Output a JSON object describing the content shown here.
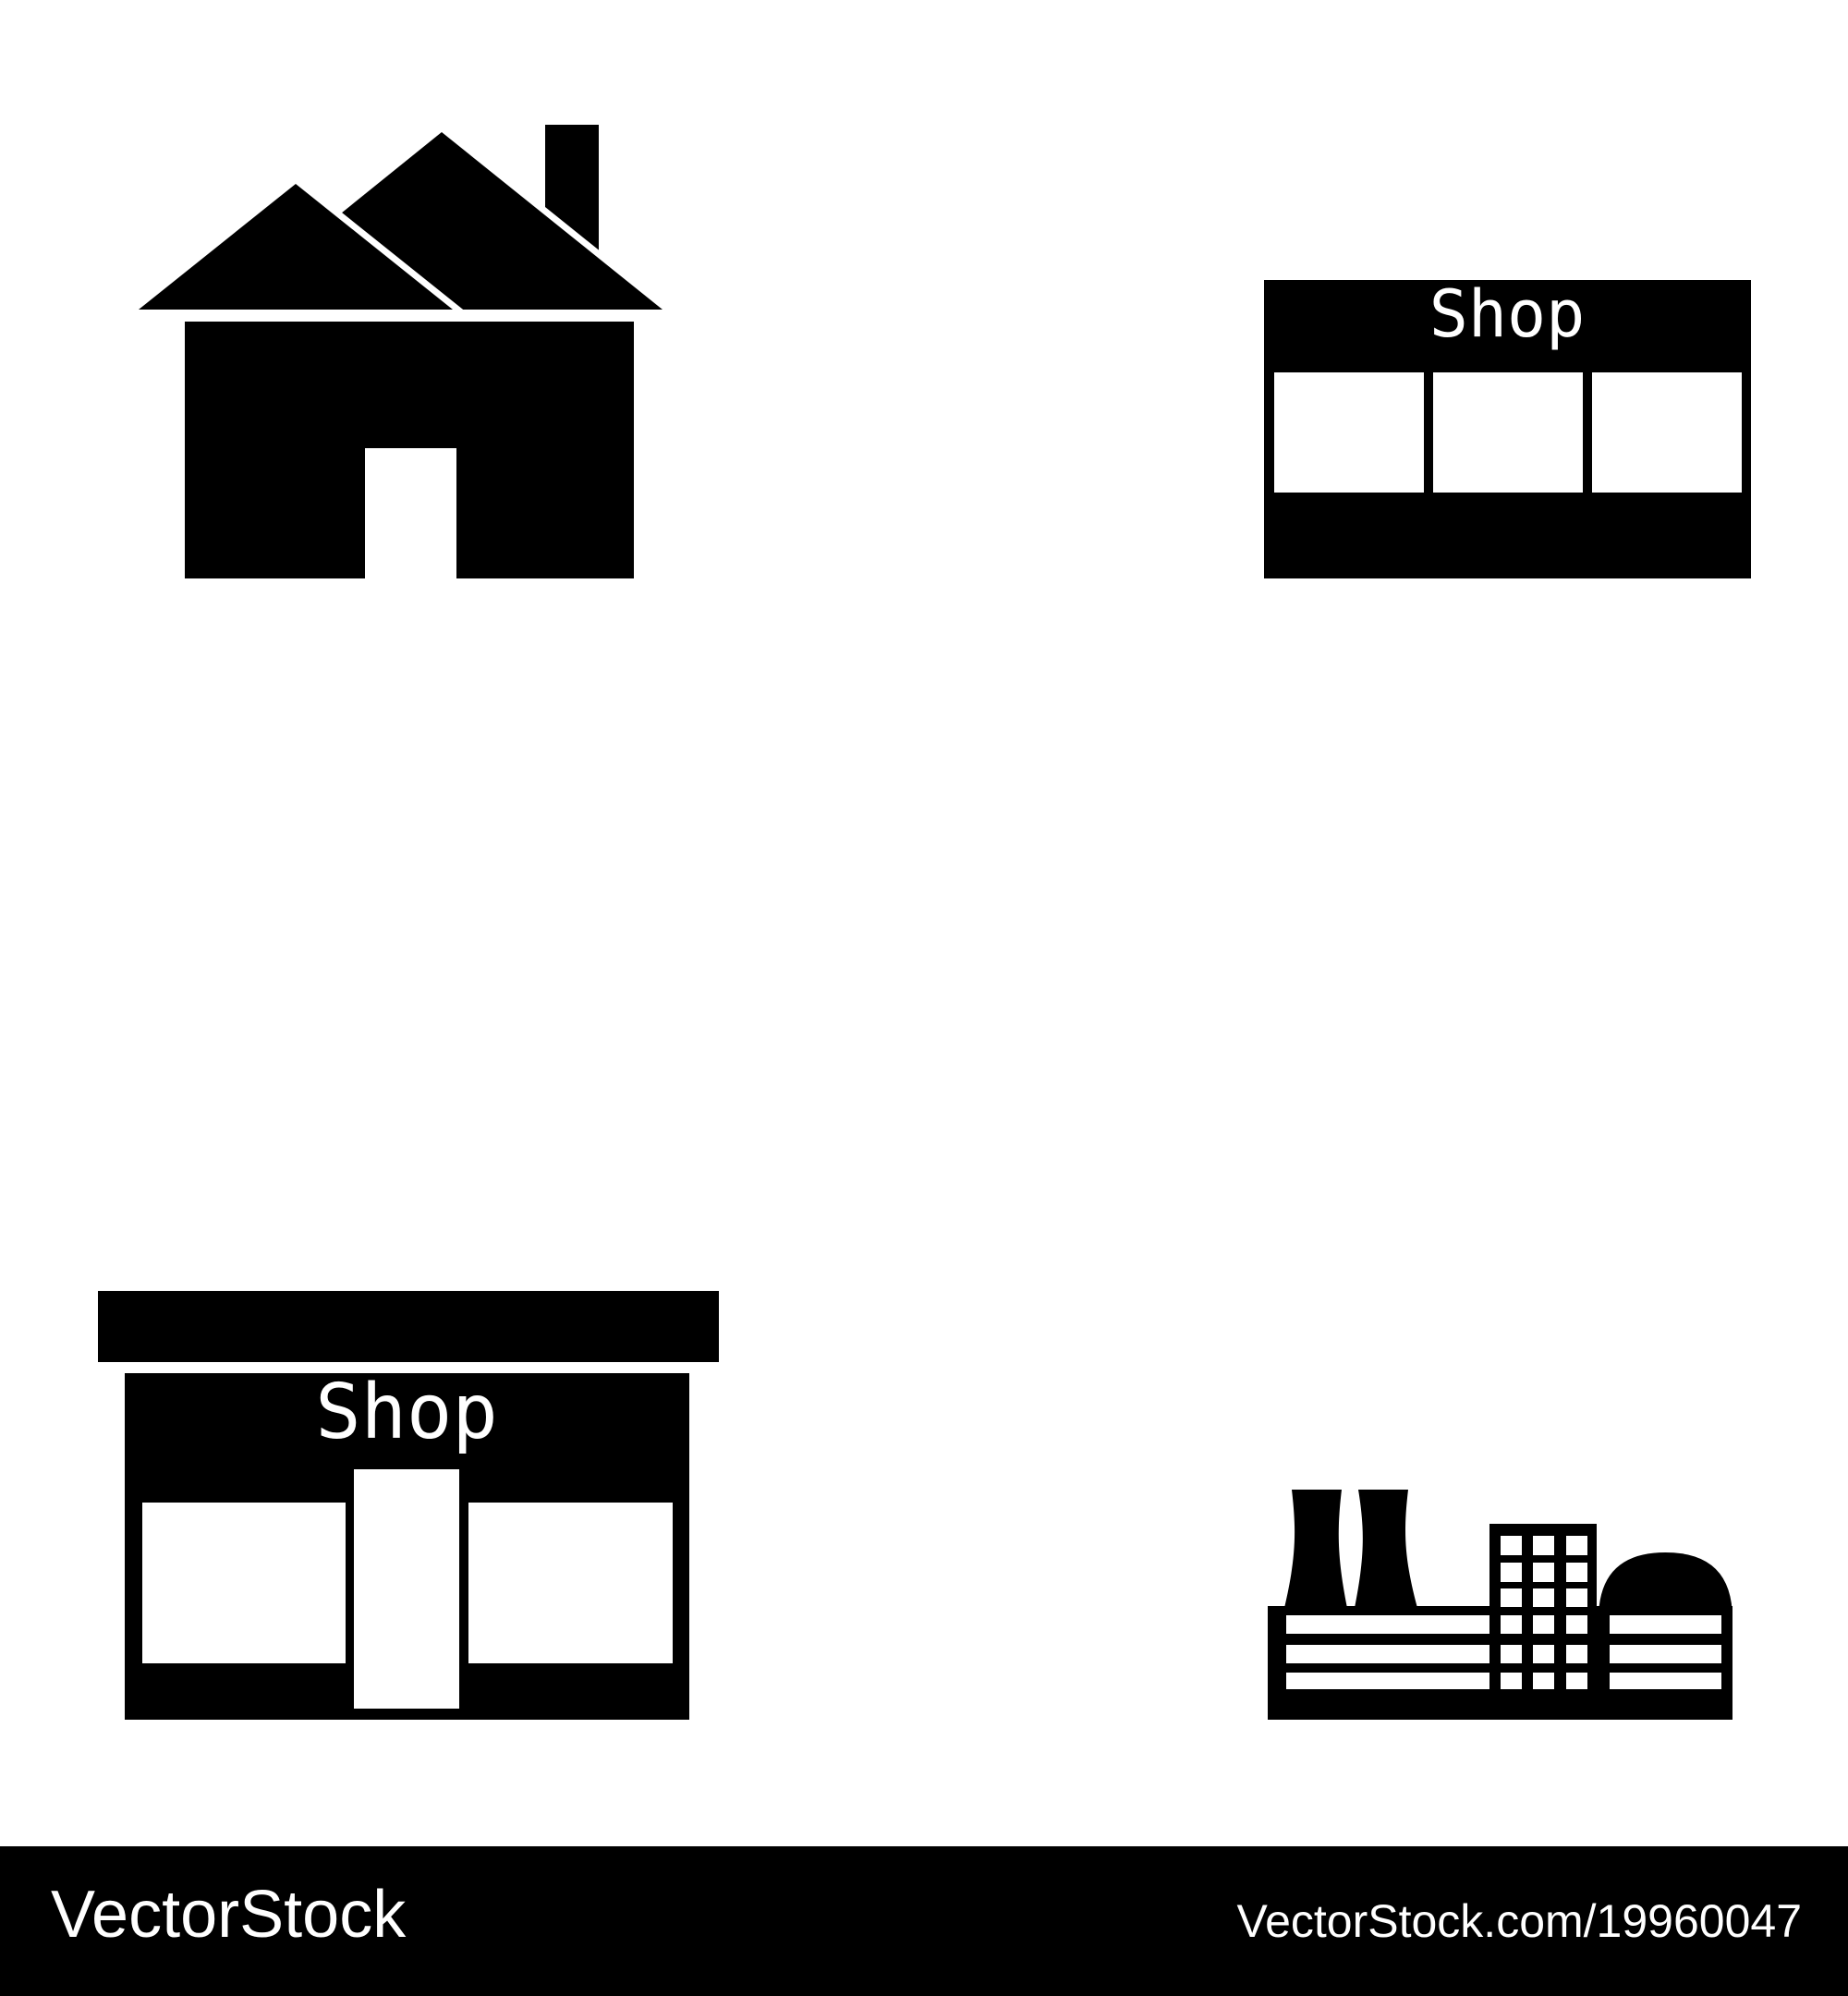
{
  "page": {
    "type": "stock-icon-set-preview",
    "background": "#ffffff"
  },
  "colors": {
    "icon": "#000000",
    "cutout": "#ffffff",
    "footer_bg": "#000000",
    "footer_text": "#ffffff"
  },
  "icons": {
    "house": {
      "name": "house"
    },
    "shop_front": {
      "sign": "Shop"
    },
    "shop_awning": {
      "sign": "Shop"
    },
    "factory": {
      "name": "factory"
    }
  },
  "footer": {
    "brand": "VectorStock",
    "credit": "VectorStock.com/19960047"
  }
}
